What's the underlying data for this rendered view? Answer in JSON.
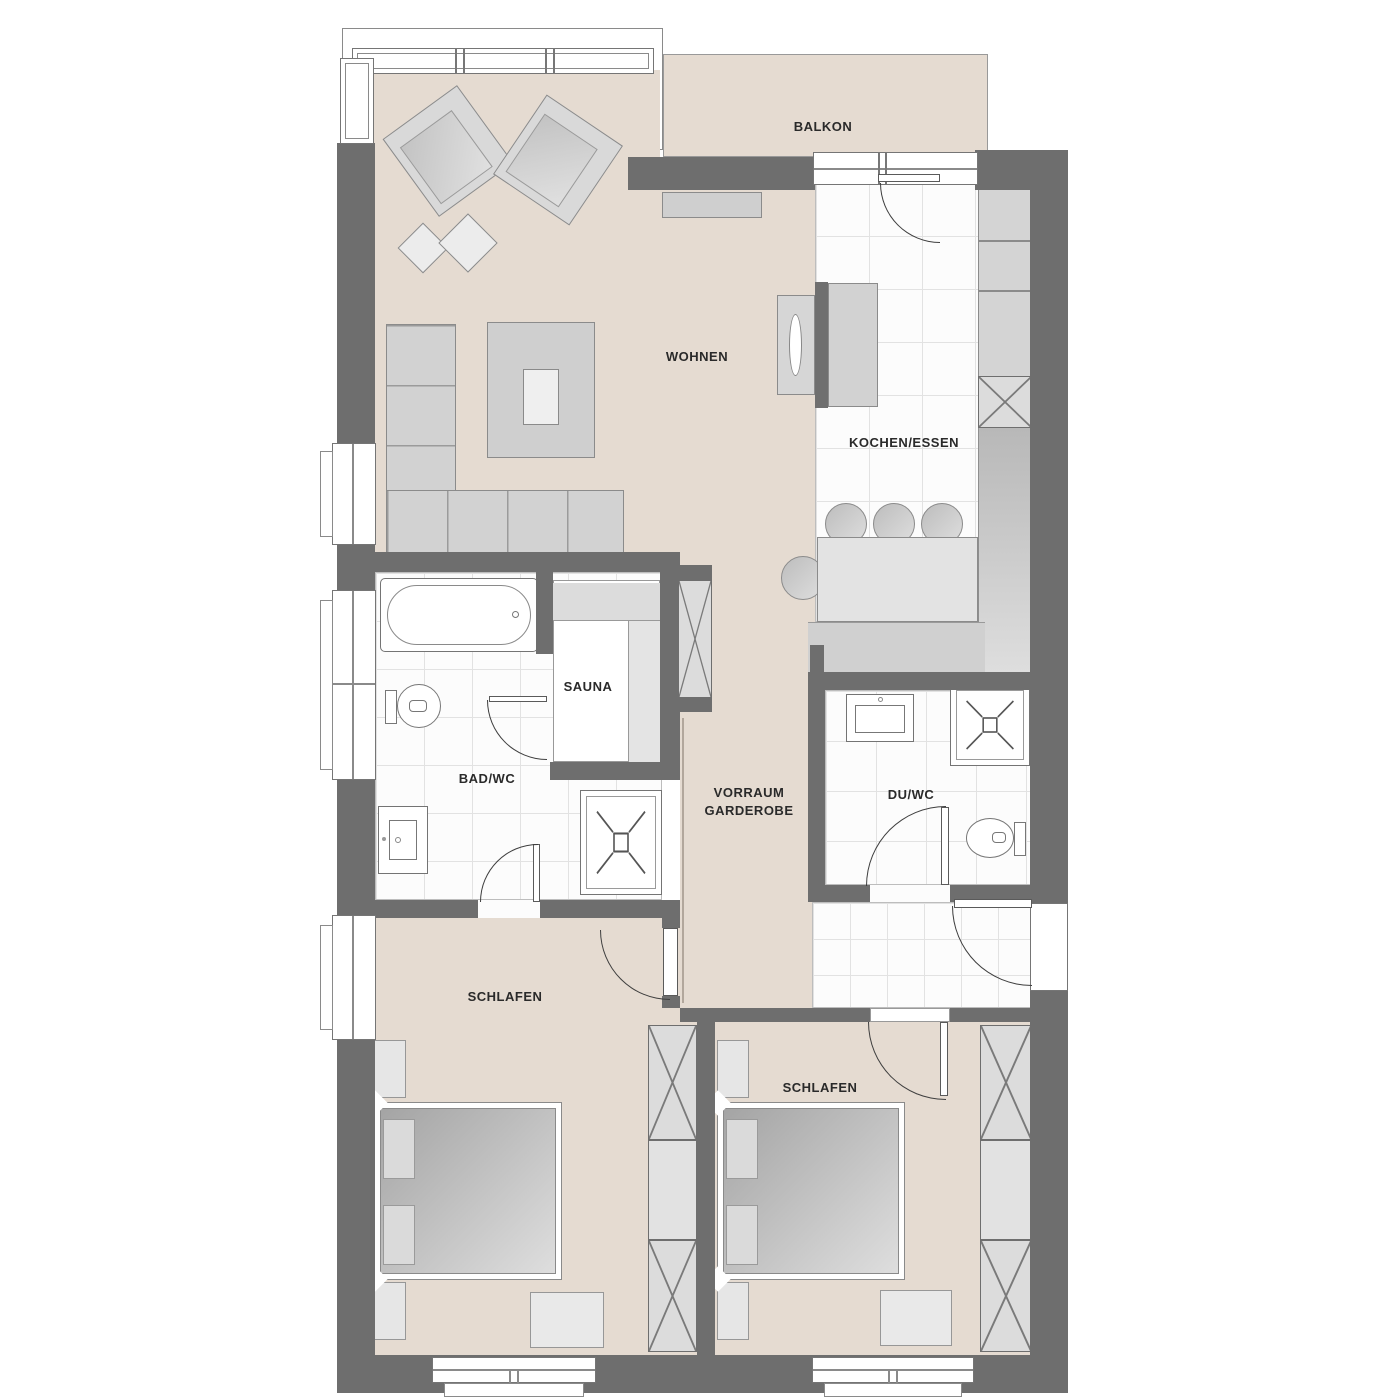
{
  "meta": {
    "type": "apartment floor plan"
  },
  "colors": {
    "wall": "#6e6e6e",
    "floor_beige": "#e5dbd1",
    "tile_white": "#fcfcfc",
    "furniture_gray": "#d6d6d6",
    "line_dark": "#3e3e3e"
  },
  "rooms": {
    "balkon": {
      "label": "BALKON"
    },
    "wohnen": {
      "label": "WOHNEN"
    },
    "kochen_essen": {
      "label": "KOCHEN/ESSEN"
    },
    "sauna": {
      "label": "SAUNA"
    },
    "bad_wc": {
      "label": "BAD/WC"
    },
    "vorraum": {
      "label_line1": "VORRAUM",
      "label_line2": "GARDEROBE"
    },
    "du_wc": {
      "label": "DU/WC"
    },
    "schlafen_1": {
      "label": "SCHLAFEN"
    },
    "schlafen_2": {
      "label": "SCHLAFEN"
    }
  }
}
